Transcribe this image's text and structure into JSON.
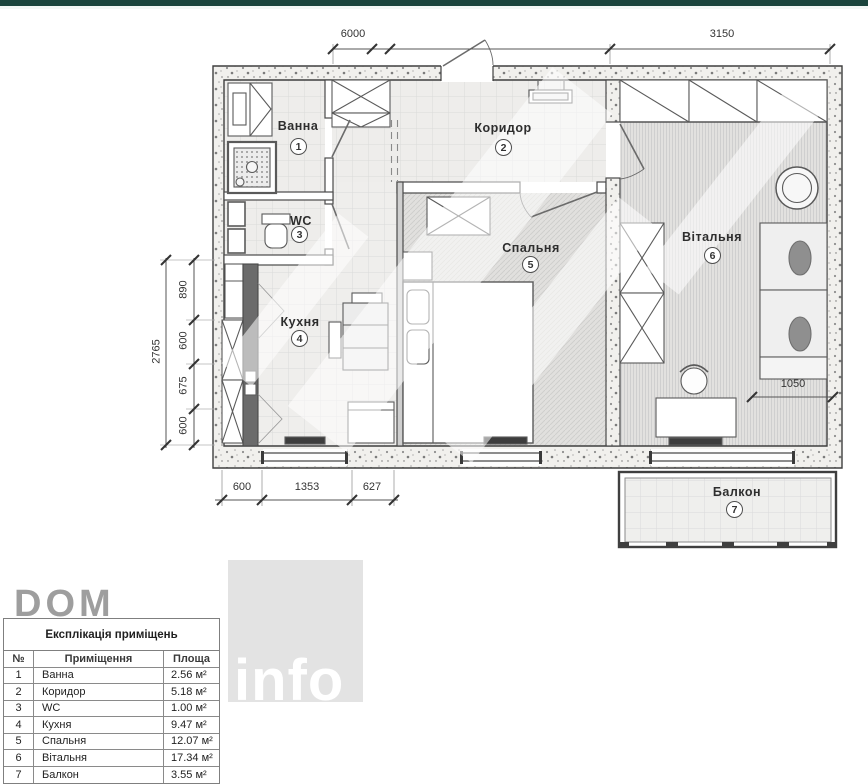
{
  "watermarks": {
    "dom": "DOM",
    "info": "info"
  },
  "plan": {
    "rooms": [
      {
        "label": "Ванна",
        "num": "1"
      },
      {
        "label": "Коридор",
        "num": "2"
      },
      {
        "label": "WC",
        "num": "3"
      },
      {
        "label": "Кухня",
        "num": "4"
      },
      {
        "label": "Спальня",
        "num": "5"
      },
      {
        "label": "Вітальня",
        "num": "6"
      },
      {
        "label": "Балкон",
        "num": "7"
      }
    ],
    "dims": {
      "top_width": "6000",
      "top_right_width": "3150",
      "left_total": "2765",
      "left_seg_1": "890",
      "left_seg_2": "600",
      "left_seg_3": "675",
      "left_seg_4": "600",
      "bottom_seg_1": "600",
      "bottom_seg_2": "1353",
      "bottom_seg_3": "627",
      "living_width": "1050"
    }
  },
  "table": {
    "title": "Експлікація приміщень",
    "columns": [
      "№",
      "Приміщення",
      "Площа"
    ],
    "rows": [
      [
        "1",
        "Ванна",
        "2.56 м²"
      ],
      [
        "2",
        "Коридор",
        "5.18 м²"
      ],
      [
        "3",
        "WC",
        "1.00 м²"
      ],
      [
        "4",
        "Кухня",
        "9.47 м²"
      ],
      [
        "5",
        "Спальня",
        "12.07 м²"
      ],
      [
        "6",
        "Вітальня",
        "17.34 м²"
      ],
      [
        "7",
        "Балкон",
        "3.55 м²"
      ]
    ]
  }
}
